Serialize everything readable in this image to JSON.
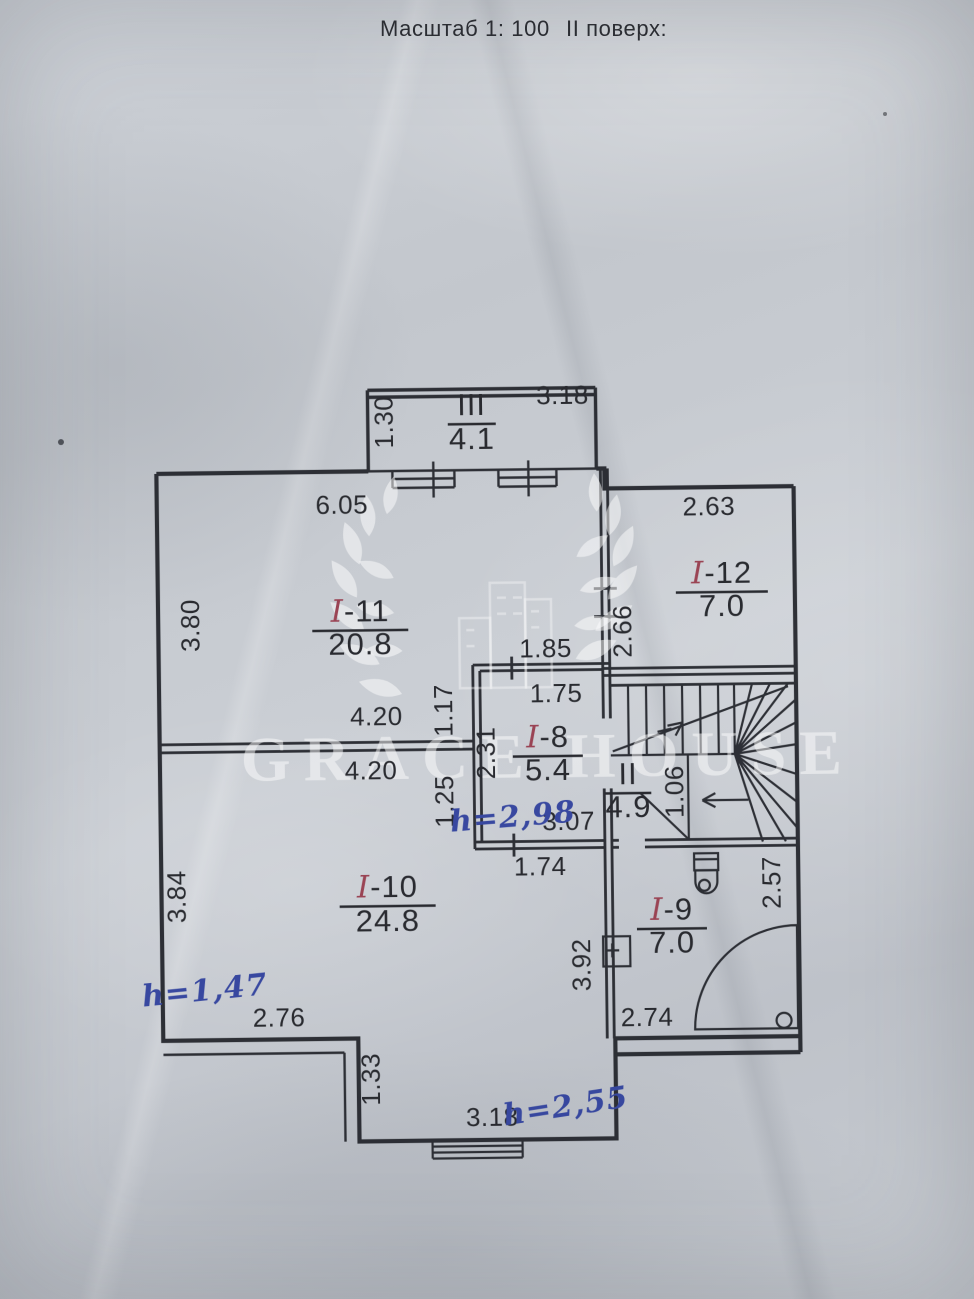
{
  "header": {
    "scale_label": "Масштаб 1: 100",
    "floor_label": "II поверх:"
  },
  "watermark": {
    "text": "GRACE HOUSE"
  },
  "rooms": [
    {
      "id": "balcony",
      "prefix": "",
      "num": "III",
      "area": "4.1",
      "x": 476,
      "ny": 415,
      "ay": 449,
      "lw": 48
    },
    {
      "id": "room-11",
      "prefix": "I",
      "num": "-11",
      "area": "20.8",
      "x": 362,
      "ny": 620,
      "ay": 653,
      "lw": 96
    },
    {
      "id": "room-12",
      "prefix": "I",
      "num": "-12",
      "area": "7.0",
      "x": 724,
      "ny": 586,
      "ay": 619,
      "lw": 92
    },
    {
      "id": "room-8",
      "prefix": "I",
      "num": "-8",
      "area": "5.4",
      "x": 548,
      "ny": 748,
      "ay": 781,
      "lw": 70
    },
    {
      "id": "stairwell",
      "prefix": "",
      "num": "II",
      "area": "4.9",
      "x": 628,
      "ny": 786,
      "ay": 819,
      "lw": 46
    },
    {
      "id": "room-10",
      "prefix": "I",
      "num": "-10",
      "area": "24.8",
      "x": 386,
      "ny": 896,
      "ay": 930,
      "lw": 96
    },
    {
      "id": "room-9",
      "prefix": "I",
      "num": "-9",
      "area": "7.0",
      "x": 670,
      "ny": 922,
      "ay": 955,
      "lw": 70
    }
  ],
  "dimensions": [
    {
      "t": "3.18",
      "x": 567,
      "y": 405,
      "r": 0
    },
    {
      "t": "1.30",
      "x": 397,
      "y": 421,
      "r": -90
    },
    {
      "t": "6.05",
      "x": 345,
      "y": 512,
      "r": 0
    },
    {
      "t": "2.63",
      "x": 712,
      "y": 518,
      "r": 0
    },
    {
      "t": "3.80",
      "x": 201,
      "y": 622,
      "r": -90
    },
    {
      "t": "2.66",
      "x": 633,
      "y": 633,
      "r": -90
    },
    {
      "t": "1.85",
      "x": 547,
      "y": 658,
      "r": 0
    },
    {
      "t": "1.75",
      "x": 557,
      "y": 703,
      "r": 0
    },
    {
      "t": "1.17",
      "x": 453,
      "y": 710,
      "r": -90
    },
    {
      "t": "2.31",
      "x": 495,
      "y": 753,
      "r": -90
    },
    {
      "t": "1.25",
      "x": 453,
      "y": 801,
      "r": -90
    },
    {
      "t": "3.07",
      "x": 568,
      "y": 831,
      "r": 0
    },
    {
      "t": "1.06",
      "x": 683,
      "y": 794,
      "r": -90
    },
    {
      "t": "4.20",
      "x": 377,
      "y": 724,
      "r": 0
    },
    {
      "t": "4.20",
      "x": 371,
      "y": 778,
      "r": 0
    },
    {
      "t": "3.84",
      "x": 184,
      "y": 893,
      "r": -90
    },
    {
      "t": "1.74",
      "x": 539,
      "y": 876,
      "r": 0
    },
    {
      "t": "2.57",
      "x": 779,
      "y": 886,
      "r": -90
    },
    {
      "t": "3.92",
      "x": 588,
      "y": 966,
      "r": -90
    },
    {
      "t": "2.76",
      "x": 276,
      "y": 1024,
      "r": 0
    },
    {
      "t": "2.74",
      "x": 644,
      "y": 1028,
      "r": 0
    },
    {
      "t": "1.33",
      "x": 376,
      "y": 1078,
      "r": -90
    },
    {
      "t": "3.18",
      "x": 488,
      "y": 1126,
      "r": 0
    }
  ],
  "annotations": [
    {
      "t": "h=2,98",
      "x": 513,
      "y": 827,
      "r": -4
    },
    {
      "t": "h=1,47",
      "x": 203,
      "y": 997,
      "r": -5
    },
    {
      "t": "h=2,55",
      "x": 563,
      "y": 1117,
      "r": -8
    }
  ],
  "colors": {
    "ink": "#22242a",
    "handwriting_red": "#96394a",
    "handwriting_blue": "#2d3f9c",
    "paper": "#c6cad0",
    "watermark": "#ffffff"
  }
}
